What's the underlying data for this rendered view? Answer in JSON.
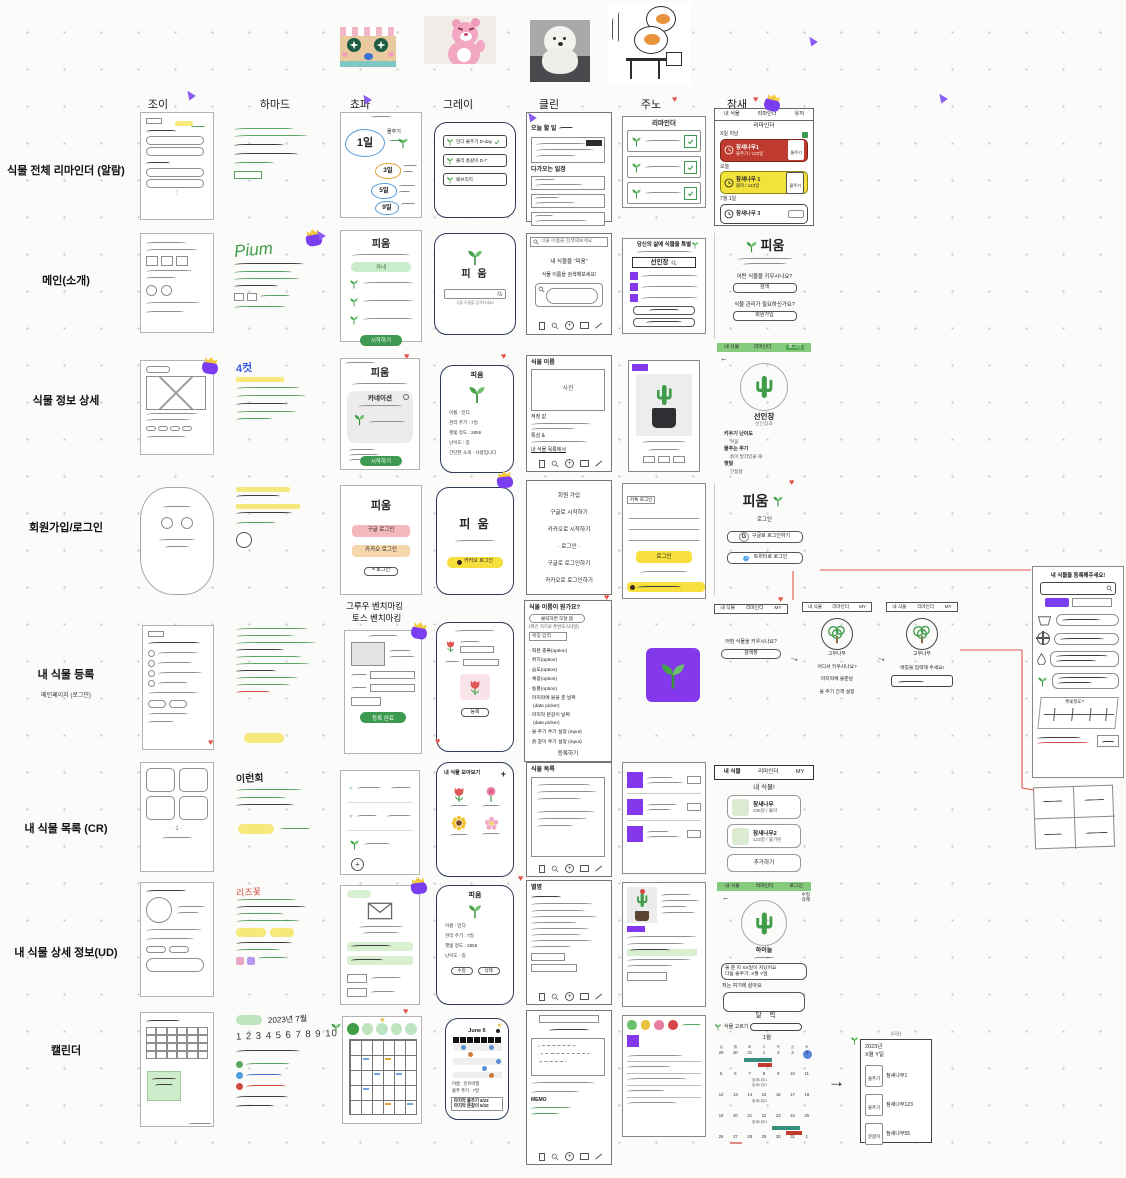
{
  "colors": {
    "green": "#3d9a50",
    "light_green": "#c9eccb",
    "tab_green": "#86ca7e",
    "red_card": "#bf3a2f",
    "yellow": "#f3df3e",
    "purple": "#7a3df0",
    "navy": "#2d3b57",
    "teal": "#3a8e80",
    "heart": "#e4574d"
  },
  "header": {
    "columns": [
      "조이",
      "하마드",
      "쵸파",
      "그레이",
      "클린",
      "주노",
      "참새"
    ]
  },
  "row_labels": [
    {
      "label": "식물 전체 리마인더 (알람)"
    },
    {
      "label": "메인(소개)"
    },
    {
      "label": "식물 정보 상세"
    },
    {
      "label": "회원가입/로그인"
    },
    {
      "label": "내 식물 등록",
      "sub": "메인페이지 (로그인)"
    },
    {
      "label": "내 식물 목록 (CR)"
    },
    {
      "label": "내 식물 상세 정보(UD)"
    },
    {
      "label": "캘린더"
    }
  ],
  "hamad": {
    "pium": "Pium",
    "cut": "4컷",
    "word1": "이런회",
    "word2": "리즈꽃",
    "date": "2023년 7월",
    "numbers": "1 2 3 4 5 6 7 8 9 10"
  },
  "chopa": {
    "alarm": {
      "day": "1일",
      "label": "물주기",
      "b1": "3일",
      "b2": "5일",
      "b3": "9일"
    },
    "main": {
      "title": "피움",
      "chip": "카네",
      "btn": "시작하기"
    },
    "detail": {
      "title": "피움",
      "card": "카네이션",
      "btn": "시작하기"
    },
    "login": {
      "title": "피움",
      "google": "구글 로그인",
      "kakao": "카카오 로그인",
      "plain": "= 로그인"
    },
    "register": {
      "bench1": "그루우 벤치마킹",
      "bench2": "토스 벤치마킹",
      "btn": "등록 완료"
    }
  },
  "gray": {
    "alarm": [
      "민디 물주기 D-day",
      "졸리 흙갈이 D-7",
      "페브리지"
    ],
    "main": {
      "title": "피 움",
      "hint": "식물 이름을 검색하세요!"
    },
    "detail": {
      "top": "피움",
      "fields": [
        "이름 : 민디",
        "관리 주기 : 7일",
        "햇빛 정도 : 2855",
        "난이도 : 중",
        "간단한 소개 : 사랑입니다"
      ]
    },
    "login": {
      "title": "피 움",
      "btn": "카카오 로그인"
    },
    "register": {
      "btn": "등록"
    },
    "list": {
      "title": "내 식물 모아보기",
      "plus": "+"
    },
    "mydetail": {
      "top": "피움",
      "fields": [
        "이름 : 민디",
        "관리 주기 : 7일",
        "햇빛 정도 : 2855",
        "난이도 : 중"
      ],
      "btn1": "수정",
      "btn2": "삭제"
    },
    "calendar": {
      "title": "June 6",
      "f1": "이름 : 민트바질",
      "f2": "물주 주기 : 7일",
      "b1": "마지막 물주기 6/23",
      "b2": "마지막 분갈이 6/10"
    }
  },
  "clean": {
    "today": {
      "h1": "오늘 할 일",
      "h2": "다가오는 일정"
    },
    "main": {
      "search": "식물 이름을 검색해보세요",
      "l1": "내 식물을 \"피움\"",
      "l2": "식물 이름을 검색해보세요!"
    },
    "detail": {
      "h": "식물 이름",
      "photo": "사진",
      "f1": "적정 값",
      "f2": "특성 &",
      "link": "내 식물 목록에서"
    },
    "login": [
      "회원 가입",
      "구글로 시작하기",
      "카카오로 시작하기",
      "· 로그인 ·",
      "구글로 로그인하기",
      "카카오로 로그인하기"
    ],
    "register": {
      "q": "식물 이름이 뭔가요?",
      "modal": "클릭하면 모달 뜸",
      "note": "(여긴 거기로 폰번호스타일)",
      "nick": "애칭 입력",
      "items": [
        "· 화분 종류(option)",
        "· 위치(option)",
        "· 습도(option)",
        "· 채광(option)",
        "· 통풍(option)",
        "· 마지막에 물을 준 날짜",
        "   (date picker)",
        "· 마지막 분갈이 날짜",
        "   (date picker)",
        "· 물 주기 주기 설정 (input)",
        "· 흙 갈이 주기 설정 (input)"
      ],
      "btn": "등록하기"
    },
    "list": {
      "h": "식물 목록"
    },
    "mydetail": {
      "h": "별명"
    },
    "calendar": {
      "memo": "MEMO"
    }
  },
  "juno": {
    "reminder": {
      "h": "리마인더"
    },
    "main": {
      "h": "당신의 삶에 식물을 특별",
      "search": "선인장"
    },
    "login": {
      "h": "카톡 로그인",
      "btn": "로그인"
    }
  },
  "sparrow": {
    "reminder": {
      "tabs": [
        "내 식물",
        "리마인더",
        "유저"
      ],
      "h": "리마인더",
      "s1": "X일 지남",
      "c1n": "참새나무1",
      "c1s": "물주기 / 123일",
      "c1b": "물주기",
      "s2": "오늘",
      "c2n": "참새나무 1",
      "c2s": "물마 / 123일",
      "c2b": "물주기",
      "s3": "7월 1일",
      "c3n": "참새나무 3"
    },
    "main": {
      "logo": "피움",
      "q1": "어떤 식물을 키우시나요?",
      "b1": "검색",
      "q2": "식물 관리가 필요하신가요?",
      "b2": "회원가입"
    },
    "detail": {
      "tabs": [
        "내 식물",
        "리마인더",
        "로그인"
      ],
      "name": "선인장",
      "family": "선인장과",
      "f1l": "키우기 난이도",
      "f1v": "쉬움",
      "f2l": "물주는 주기",
      "f2v": "흙이 말라있을 때",
      "f3l": "햇빛",
      "f3v": "간접광"
    },
    "login": {
      "logo": "피움",
      "h": "로그인",
      "g": "구글로 로그인하기",
      "t": "트위터로 로그인"
    },
    "register": {
      "tabs": [
        "내 식물",
        "리마인더",
        "MY"
      ],
      "q": "어떤 식물을 키우시나요?",
      "box": "검색창",
      "tree": "고무나무",
      "l1": "어디서 키우시나요?",
      "l2": "마지막에 물준날",
      "l3": "물 주기 간격 설정",
      "p3": "애칭을 입력해 주세요!"
    },
    "list": {
      "tabs": [
        "내 식물",
        "리마인더",
        "MY"
      ],
      "h": "내 식물!",
      "c1n": "참새나무",
      "c1s": "235일 / 물마",
      "c2n": "참새나무2",
      "c2s": "123일 / 꽃기린",
      "btn": "추가하기"
    },
    "mydetail": {
      "tabs": [
        "내 식물",
        "리마인더",
        "로그인"
      ],
      "e1": "수정",
      "e2": "삭제",
      "name": "하이늘",
      "b1": "물 준 지 XX일이 지났어요",
      "b2": "다음 물주기: X월 Y일",
      "loc": "저는 여기에 살아요"
    },
    "calendar": {
      "h": "달 력",
      "picker": "식물 고르기",
      "month": "1월",
      "dows": [
        "일",
        "월",
        "화",
        "수",
        "목",
        "금",
        "토"
      ],
      "days": [
        "29",
        "30",
        "31",
        "1",
        "2",
        "3",
        "4",
        "5",
        "6",
        "7",
        "8",
        "9",
        "10",
        "11",
        "12",
        "13",
        "14",
        "15",
        "16",
        "17",
        "18",
        "19",
        "20",
        "21",
        "22",
        "23",
        "24",
        "25",
        "26",
        "27",
        "28",
        "29",
        "30",
        "31",
        "1"
      ],
      "e8a": "참새나무1",
      "e8b": "참새나무1",
      "e15": "참새나무1",
      "e22": "참새나무1",
      "modal_cap": "(모달)",
      "modal_y": "2023년",
      "modal_d": "X월 Y일",
      "m1t": "물주기",
      "m1n": "참새나무1",
      "m2t": "물주기",
      "m2n": "참새나무123",
      "m3t": "분갈이",
      "m3n": "참새나무55"
    }
  },
  "farright": {
    "title": "내 식물을 등록해주세요!",
    "slider": "햇빛정도?"
  }
}
